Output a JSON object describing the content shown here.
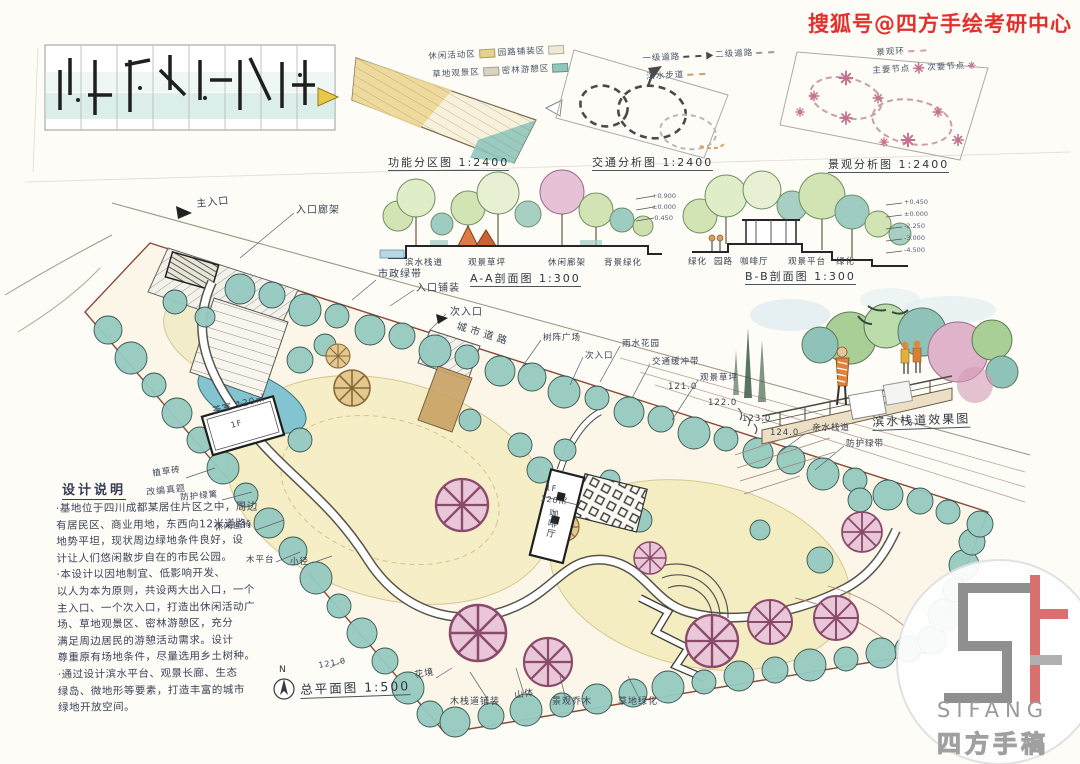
{
  "palette": {
    "accent_red": "#e3302c",
    "teal": "#8fc6bd",
    "lawn": "#f6eec6",
    "water": "#82c5d0",
    "ink": "#3a4150",
    "contour_brown": "#b08573",
    "logo_red": "#d87070",
    "logo_gray": "#8f8f8f"
  },
  "watermark": {
    "text": "搜狐号@四方手绘考研中心"
  },
  "diagrams": {
    "function": {
      "caption": "功能分区图 1:2400",
      "legend": [
        "休闲活动区",
        "园路铺装区",
        "草地观景区",
        "密林游憩区"
      ]
    },
    "traffic": {
      "caption": "交通分析图 1:2400",
      "legend": [
        "一级道路",
        "二级道路",
        "滨水步道"
      ]
    },
    "landscape": {
      "caption": "景观分析图 1:2400",
      "legend": [
        "景观环",
        "主要节点",
        "次要节点"
      ]
    }
  },
  "sections": {
    "aa": {
      "caption": "A-A剖面图 1:300",
      "labels": [
        "滨水栈道",
        "观景草坪",
        "休闲廊架",
        "背景绿化"
      ],
      "elevations": [
        "+0.900",
        "±0.000",
        "-0.450"
      ]
    },
    "bb": {
      "caption": "B-B剖面图 1:300",
      "labels": [
        "绿化",
        "园路",
        "咖啡厅",
        "观景平台",
        "绿化"
      ],
      "elevations": [
        "+0.450",
        "±0.000",
        "-2.250",
        "-3.000",
        "-4.500"
      ]
    }
  },
  "perspective": {
    "caption": "滨水栈道效果图"
  },
  "plan": {
    "caption": "总平面图 1:500",
    "north": "N",
    "labels": {
      "main_entrance": "主入口",
      "entrance_pergola": "入口廊架",
      "municipal_green": "市政绿带",
      "entrance_paving": "入口铺装",
      "secondary_entrance": "次入口",
      "city_road": "城市道路",
      "tree_plaza": "树阵广场",
      "secondary_entrance2": "次入口",
      "rain_garden": "雨水花园",
      "traffic_buffer": "交通缓冲带",
      "lawn": "观景草坪",
      "waterside_walk": "亲水栈道",
      "protective_green": "防护绿带",
      "grass_paver": "植草砖",
      "hedge": "防护绿篱",
      "bench": "休闲座椅",
      "wood_deck": "木平台",
      "trail": "小径",
      "teahouse": "茶室 120㎡",
      "teahouse_floor": "1F",
      "cafe_floor": "1F",
      "cafe_area": "120㎡",
      "cafe": "咖啡厅",
      "flower_border": "花境",
      "boardwalk_paving": "木栈道铺装",
      "hill": "山体",
      "landscape_trees": "景观乔木",
      "grass_green": "草地绿化"
    },
    "contours": [
      "121.0",
      "122.0",
      "123.0",
      "124.0"
    ],
    "contour_bottom": "121.0"
  },
  "notes": {
    "title": "设计说明",
    "tag": "改编真题",
    "lines": [
      "·基地位于四川成都某居住片区之中，周边",
      "有居民区、商业用地，东西向12米道路，",
      "地势平坦，现状周边绿地条件良好，设",
      "计让人们悠闲散步自在的市民公园。",
      "·本设计以因地制宜、低影响开发、",
      "以人为本为原则，共设两大出入口，一个",
      "主入口、一个次入口，打造出休闲活动广",
      "场、草地观景区、密林游憩区，充分",
      "满足周边居民的游憩活动需求。设计",
      "尊重原有场地条件，尽量选用乡土树种。",
      "·通过设计滨水平台、观景长廊、生态",
      "绿岛、微地形等要素，打造丰富的城市",
      "绿地开放空间。"
    ]
  },
  "logo": {
    "name": "SIFANG",
    "cn": "四方手稿"
  }
}
